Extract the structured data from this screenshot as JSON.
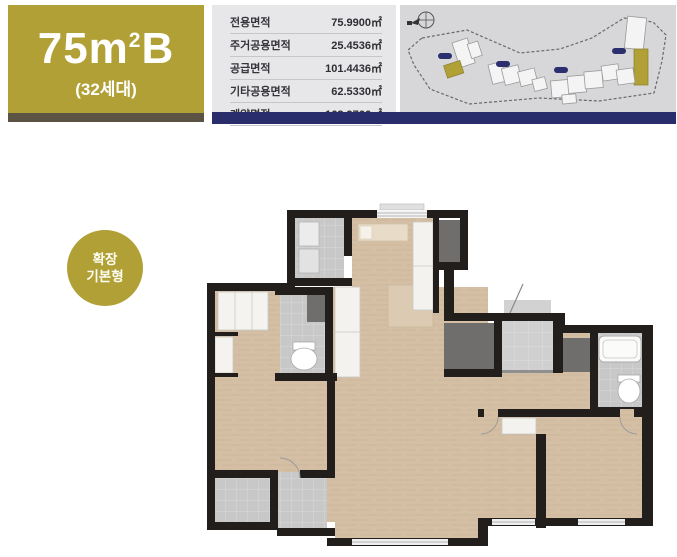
{
  "unit": {
    "title_main": "75m",
    "title_sup": "2",
    "title_suffix": "B",
    "household_count": "(32세대)"
  },
  "area_table": {
    "rows": [
      {
        "label": "전용면적",
        "value": "75.9900㎡"
      },
      {
        "label": "주거공용면적",
        "value": "25.4536㎡"
      },
      {
        "label": "공급면적",
        "value": "101.4436㎡"
      },
      {
        "label": "기타공용면적",
        "value": "62.5330㎡"
      },
      {
        "label": "계약면적",
        "value": "163.9766㎡"
      }
    ]
  },
  "badge": {
    "line1": "확장",
    "line2": "기본형"
  },
  "colors": {
    "gold": "#b1a036",
    "navy": "#292d6c",
    "brown_accent": "#5d5345",
    "table_bg": "#e7e7e9",
    "site_plan_bg": "#d7d7d9",
    "floor_wood": "#d4bfa4",
    "wall": "#211e1b",
    "tile_gray": "#c8c8c8",
    "dark_alcove": "#6f6e6c",
    "marker_navy": "#2b2f6e"
  }
}
